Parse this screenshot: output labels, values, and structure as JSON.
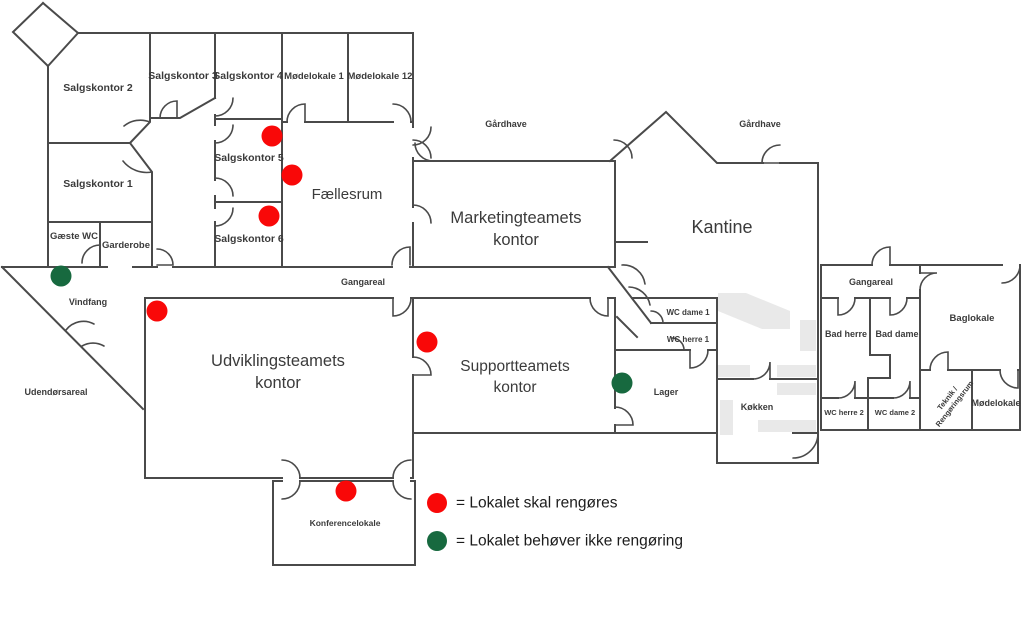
{
  "title": "Floor plan cleaning status",
  "colors": {
    "red": "#f90808",
    "green": "#17693f",
    "wall": "#4a4a4a",
    "fixture": "#e9e9e9",
    "label": "#3b3b3b",
    "legend_text": "#1c1c1c"
  },
  "rooms": [
    {
      "id": "salgskontor-2",
      "label": "Salgskontor 2",
      "x": 98,
      "y": 88,
      "size": 10.5,
      "weight": 600
    },
    {
      "id": "salgskontor-3",
      "label": "Salgskontor 3",
      "x": 183,
      "y": 76,
      "size": 10.5,
      "weight": 600
    },
    {
      "id": "salgskontor-4",
      "label": "Salgskontor 4",
      "x": 248,
      "y": 76,
      "size": 10.5,
      "weight": 600
    },
    {
      "id": "modelokale-1",
      "label": "Mødelokale 1",
      "x": 314,
      "y": 76,
      "size": 9.5,
      "weight": 600
    },
    {
      "id": "modelokale-12",
      "label": "Mødelokale 12",
      "x": 380,
      "y": 76,
      "size": 9.5,
      "weight": 600
    },
    {
      "id": "salgskontor-1",
      "label": "Salgskontor 1",
      "x": 98,
      "y": 184,
      "size": 10.5,
      "weight": 600
    },
    {
      "id": "salgskontor-5",
      "label": "Salgskontor 5",
      "x": 249,
      "y": 158,
      "size": 10.5,
      "weight": 600
    },
    {
      "id": "salgskontor-6",
      "label": "Salgskontor 6",
      "x": 249,
      "y": 239,
      "size": 10.5,
      "weight": 600
    },
    {
      "id": "gaeste-wc",
      "label": "Gæste WC",
      "x": 74,
      "y": 236,
      "size": 9.5,
      "weight": 600
    },
    {
      "id": "garderobe",
      "label": "Garderobe",
      "x": 126,
      "y": 245,
      "size": 9.5,
      "weight": 600
    },
    {
      "id": "faellesrum",
      "label": "Fællesrum",
      "x": 347,
      "y": 194,
      "size": 15,
      "weight": 500
    },
    {
      "id": "gaardhave-1",
      "label": "Gårdhave",
      "x": 506,
      "y": 124,
      "size": 9,
      "weight": 600
    },
    {
      "id": "gaardhave-2",
      "label": "Gårdhave",
      "x": 760,
      "y": 124,
      "size": 9,
      "weight": 600
    },
    {
      "id": "marketingteamets-kontor",
      "lines": [
        "Marketingteamets",
        "kontor"
      ],
      "x": 516,
      "y": 218,
      "size": 16.5,
      "weight": 500,
      "lh": 22
    },
    {
      "id": "kantine",
      "label": "Kantine",
      "x": 722,
      "y": 227,
      "size": 18,
      "weight": 500
    },
    {
      "id": "gangareal-1",
      "label": "Gangareal",
      "x": 363,
      "y": 282,
      "size": 9,
      "weight": 600
    },
    {
      "id": "gangareal-2",
      "label": "Gangareal",
      "x": 871,
      "y": 282,
      "size": 9,
      "weight": 600
    },
    {
      "id": "vindfang",
      "label": "Vindfang",
      "x": 88,
      "y": 302,
      "size": 9,
      "weight": 600
    },
    {
      "id": "udendorsareal",
      "label": "Udendørsareal",
      "x": 56,
      "y": 392,
      "size": 9,
      "weight": 600
    },
    {
      "id": "udviklingsteamets-kontor",
      "lines": [
        "Udviklingsteamets",
        "kontor"
      ],
      "x": 278,
      "y": 361,
      "size": 16.5,
      "weight": 500,
      "lh": 22
    },
    {
      "id": "supportteamets-kontor",
      "lines": [
        "Supportteamets",
        "kontor"
      ],
      "x": 515,
      "y": 366,
      "size": 15.5,
      "weight": 500,
      "lh": 21
    },
    {
      "id": "wc-dame-1",
      "label": "WC dame 1",
      "x": 688,
      "y": 312,
      "size": 8,
      "weight": 600
    },
    {
      "id": "wc-herre-1",
      "label": "WC herre 1",
      "x": 688,
      "y": 339,
      "size": 8,
      "weight": 600
    },
    {
      "id": "lager",
      "label": "Lager",
      "x": 666,
      "y": 392,
      "size": 9,
      "weight": 600
    },
    {
      "id": "kokken",
      "label": "Køkken",
      "x": 757,
      "y": 407,
      "size": 9,
      "weight": 600
    },
    {
      "id": "bad-herre",
      "label": "Bad herre",
      "x": 846,
      "y": 334,
      "size": 9,
      "weight": 600
    },
    {
      "id": "bad-dame",
      "label": "Bad dame",
      "x": 897,
      "y": 334,
      "size": 9,
      "weight": 600
    },
    {
      "id": "wc-herre-2",
      "label": "WC herre 2",
      "x": 844,
      "y": 412,
      "size": 7.5,
      "weight": 600
    },
    {
      "id": "wc-dame-2",
      "label": "WC dame 2",
      "x": 895,
      "y": 412,
      "size": 7.5,
      "weight": 600
    },
    {
      "id": "baglokale",
      "label": "Baglokale",
      "x": 972,
      "y": 318,
      "size": 9.5,
      "weight": 600
    },
    {
      "id": "teknik-rengoringsrum",
      "lines": [
        "Teknik /",
        "Rengøringsrum"
      ],
      "x": 947,
      "y": 398,
      "size": 7.5,
      "weight": 600,
      "lh": 9,
      "rotate": -52
    },
    {
      "id": "modelokale-annex",
      "label": "Mødelokale",
      "x": 996,
      "y": 403,
      "size": 9,
      "weight": 600
    },
    {
      "id": "konferencelokale",
      "label": "Konferencelokale",
      "x": 345,
      "y": 523,
      "size": 8.5,
      "weight": 600
    }
  ],
  "dots": [
    {
      "room": "salgskontor-5",
      "x": 272,
      "y": 136,
      "status": "red"
    },
    {
      "room": "faellesrum",
      "x": 292,
      "y": 175,
      "status": "red"
    },
    {
      "room": "salgskontor-6",
      "x": 269,
      "y": 216,
      "status": "red"
    },
    {
      "room": "vindfang",
      "x": 61,
      "y": 276,
      "status": "green"
    },
    {
      "room": "udviklingsteamets-kontor",
      "x": 157,
      "y": 311,
      "status": "red"
    },
    {
      "room": "supportteamets-kontor",
      "x": 427,
      "y": 342,
      "status": "red"
    },
    {
      "room": "lager",
      "x": 622,
      "y": 383,
      "status": "green"
    },
    {
      "room": "konferencelokale",
      "x": 346,
      "y": 491,
      "status": "red"
    }
  ],
  "dot_radius": 10.5,
  "legend": {
    "dot_radius": 10,
    "text_size": 15.5,
    "items": [
      {
        "status": "red",
        "label": "= Lokalet skal rengøres",
        "x": 437,
        "y": 503
      },
      {
        "status": "green",
        "label": "= Lokalet behøver ikke rengøring",
        "x": 437,
        "y": 541
      }
    ]
  }
}
